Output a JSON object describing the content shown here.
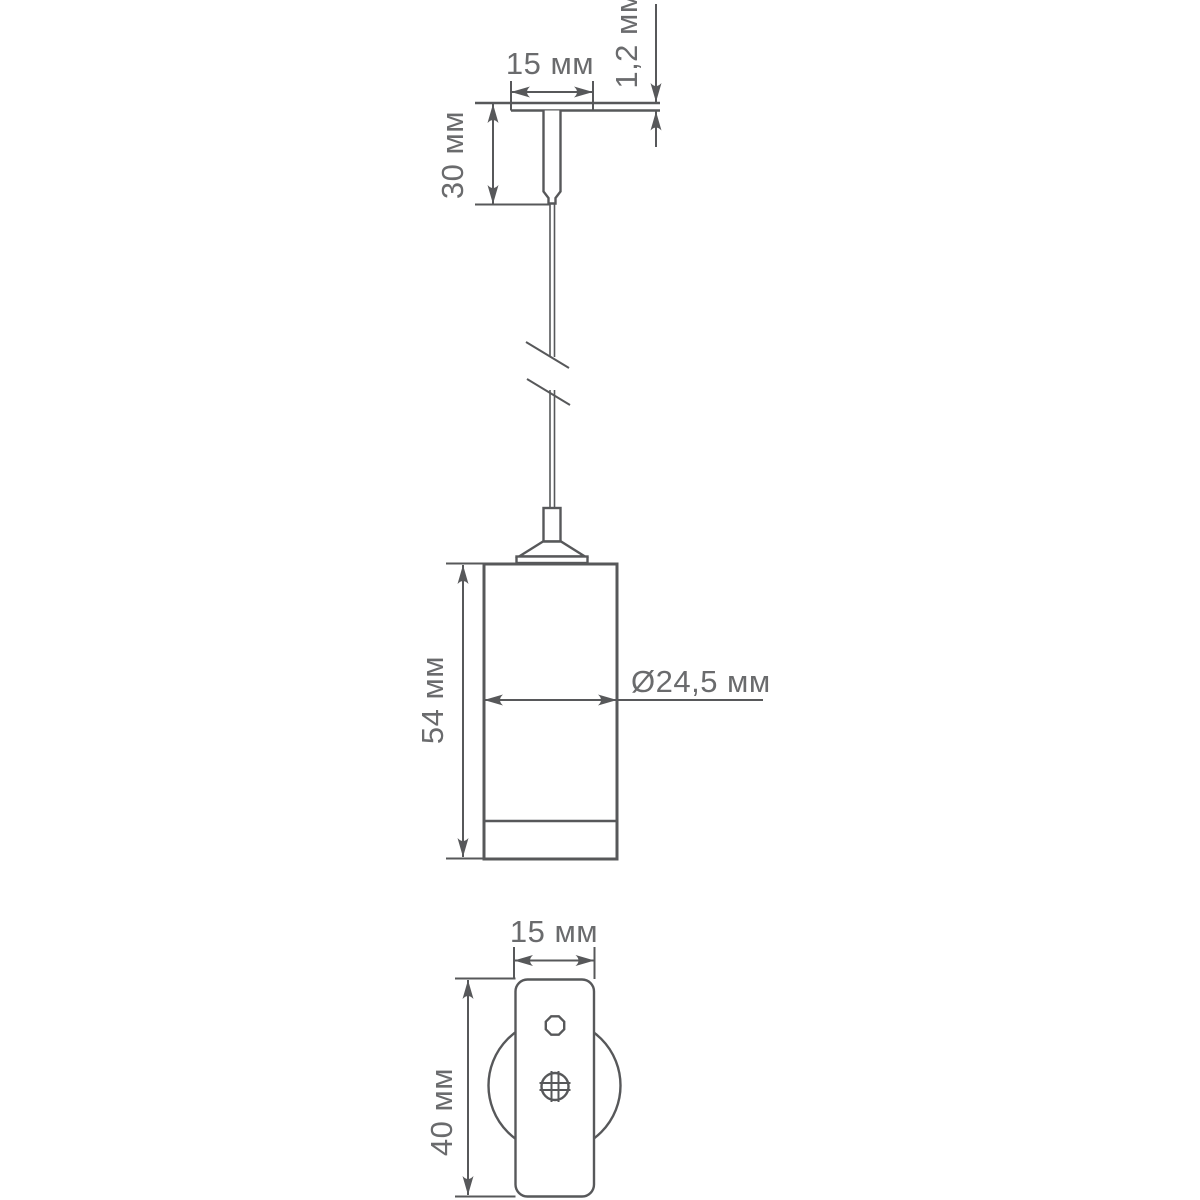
{
  "drawing": {
    "type": "technical-dimension-drawing",
    "subject": "pendant-light-fixture",
    "background_color": "#ffffff",
    "line_color": "#57585a",
    "text_color": "#6a6b6d",
    "views": {
      "ceiling_mount_side": {
        "plate_width_label": "15 мм",
        "plate_thickness_label": "1,2 мм",
        "stem_height_label": "30 мм"
      },
      "pendant_body": {
        "body_height_label": "54 мм",
        "body_diameter_label": "Ø24,5 мм"
      },
      "mount_plate_front": {
        "plate_width_label": "15 мм",
        "plate_height_label": "40 мм"
      }
    }
  }
}
